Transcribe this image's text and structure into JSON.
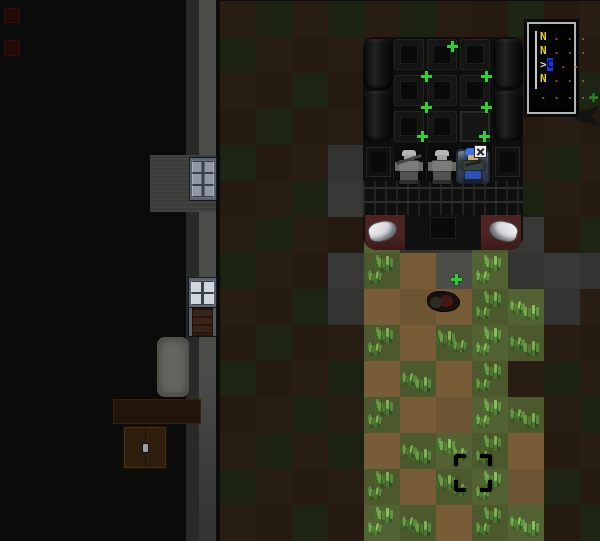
{
  "scene": {
    "width": 600,
    "height": 541,
    "tile_size": 36,
    "origin_x": 4,
    "origin_y": 1,
    "terrain_legend": {
      "K": {
        "name": "unseen",
        "color": "#0b0b0b"
      },
      "d": {
        "name": "dark-dirt",
        "color": "#241a10"
      },
      "g": {
        "name": "dark-grass",
        "color": "#1c2212"
      },
      "p": {
        "name": "dark-pavement",
        "color": "#333431"
      },
      "P": {
        "name": "lit-pavement",
        "color": "#4c4d49"
      },
      "D": {
        "name": "lit-dirt",
        "color": "#6d5433"
      },
      "G": {
        "name": "lit-grass",
        "color": "#4b592d"
      }
    },
    "map": [
      "KKKKKKdgdgdgddgdd",
      "KKKKKKgddddddddgd",
      "KKKKKKddgdddddgdg",
      "KKKKKKdgddddddddd",
      "KKKKKKgddpdddddgd",
      "KKKKKKddgpddddgdd",
      "KKKKKKdgddGppGpdg",
      "KKKKKKgddpGDPGppp",
      "KKKKKKddgpDDDGGpd",
      "KKKKKKdgddGDGGGdd",
      "KKKKKKgddgDGDGdgd",
      "KKKKKKddgdGDDGGdg",
      "KKKKKKdgdgDGGGDdd",
      "KKKKKKgdddGDGGDgd",
      "KKKKKKddgdGGDGGdg"
    ]
  },
  "structures": [
    {
      "type": "red-marker",
      "name": "red-floor-marker",
      "x": 4,
      "y": 8,
      "w": 16,
      "h": 15
    },
    {
      "type": "red-marker",
      "name": "red-floor-marker",
      "x": 4,
      "y": 40,
      "w": 16,
      "h": 16
    },
    {
      "type": "wall-dark",
      "name": "wall-inner-edge",
      "x": 186,
      "y": 0,
      "w": 13,
      "h": 541
    },
    {
      "type": "wall-light",
      "name": "wall-outer-edge",
      "x": 199,
      "y": 0,
      "w": 17,
      "h": 541
    },
    {
      "type": "floor-gray",
      "name": "wall-corner-floor",
      "x": 150,
      "y": 155,
      "w": 66,
      "h": 57
    },
    {
      "type": "window-dim",
      "name": "window",
      "x": 190,
      "y": 158,
      "w": 26,
      "h": 42
    },
    {
      "type": "window-lit",
      "name": "window",
      "x": 189,
      "y": 278,
      "w": 27,
      "h": 30
    },
    {
      "type": "door-wood",
      "name": "wooden-door",
      "x": 189,
      "y": 308,
      "w": 27,
      "h": 28
    },
    {
      "type": "bed",
      "name": "bed",
      "x": 157,
      "y": 337,
      "w": 32,
      "h": 60
    },
    {
      "type": "table",
      "name": "table",
      "x": 113,
      "y": 399,
      "w": 88,
      "h": 25
    },
    {
      "type": "dresser",
      "name": "dresser",
      "x": 122,
      "y": 425,
      "w": 46,
      "h": 45
    },
    {
      "type": "shadow-bird",
      "name": "dark-shape",
      "x": 571,
      "y": 106,
      "w": 29,
      "h": 22
    },
    {
      "type": "corpse",
      "name": "corpse-item",
      "x": 427,
      "y": 291,
      "w": 33,
      "h": 21
    }
  ],
  "vehicle": {
    "x": 363,
    "y": 37,
    "w": 160,
    "h": 213,
    "boards": [
      [
        0,
        2
      ],
      [
        0,
        54
      ],
      [
        130,
        2
      ],
      [
        130,
        54
      ]
    ],
    "cargo_cols": [
      31,
      64,
      97
    ],
    "cargo_rows": [
      2,
      38,
      74
    ],
    "controls_cell": [
      2,
      2
    ],
    "door_panels": [
      [
        3,
        110
      ],
      [
        132,
        110
      ]
    ],
    "controls_icon": {
      "x": 474,
      "y": 145
    }
  },
  "characters": [
    {
      "id": "npc-1",
      "palette": "gray",
      "x": 395,
      "y": 149,
      "rifle": true,
      "seated": false
    },
    {
      "id": "npc-2",
      "palette": "gray",
      "x": 428,
      "y": 149,
      "rifle": false,
      "seated": false
    },
    {
      "id": "player",
      "palette": "blue",
      "x": 459,
      "y": 148,
      "rifle": false,
      "seated": true
    }
  ],
  "plus_markers": [
    {
      "x": 447,
      "y": 41
    },
    {
      "x": 421,
      "y": 71
    },
    {
      "x": 481,
      "y": 71
    },
    {
      "x": 421,
      "y": 102
    },
    {
      "x": 481,
      "y": 102
    },
    {
      "x": 417,
      "y": 131
    },
    {
      "x": 479,
      "y": 131
    },
    {
      "x": 451,
      "y": 274
    },
    {
      "x": 588,
      "y": 92,
      "dim": true
    }
  ],
  "reticle": {
    "x": 454,
    "y": 454,
    "size": 38
  },
  "minimap": {
    "x": 527,
    "y": 22,
    "w": 49,
    "h": 92,
    "rows": [
      {
        "segments": [
          {
            "text": "N ",
            "style": "letter"
          },
          {
            "text": ". . .",
            "style": "dots"
          }
        ]
      },
      {
        "segments": [
          {
            "text": "N ",
            "style": "letter"
          },
          {
            "text": ". . .",
            "style": "dots"
          }
        ]
      },
      {
        "segments": [
          {
            "text": ">",
            "style": "cursor"
          },
          {
            "text": "C",
            "style": "selected"
          },
          {
            "text": " . .",
            "style": "dots"
          }
        ]
      },
      {
        "segments": [
          {
            "text": "N ",
            "style": "letter"
          },
          {
            "text": ". . .",
            "style": "dots"
          }
        ]
      },
      {
        "segments": [
          {
            "text": ". . . . .",
            "style": "dots-dim"
          }
        ]
      }
    ]
  },
  "colors": {
    "accent_green": "#2fd12f",
    "minimap_letter": "#e8d700",
    "minimap_highlight": "#1537e0",
    "minimap_dots": "#8a5f2e",
    "bumper_red": "#4e2423",
    "headlight": "#d6d9dc"
  }
}
